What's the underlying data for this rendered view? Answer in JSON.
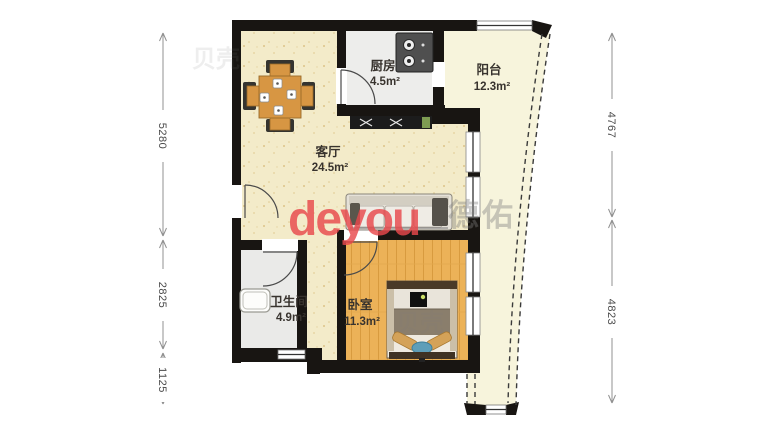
{
  "rooms": [
    {
      "name": "客厅",
      "area": "24.5m²"
    },
    {
      "name": "厨房",
      "area": "4.5m²"
    },
    {
      "name": "阳台",
      "area": "12.3m²"
    },
    {
      "name": "卫生间",
      "area": "4.9m²"
    },
    {
      "name": "卧室",
      "area": "11.3m²"
    }
  ],
  "dimensions": {
    "left": [
      "5280",
      "2825",
      "1125"
    ],
    "right": [
      "4767",
      "4823"
    ]
  },
  "watermark": {
    "logo": "deyou",
    "brand_cjk": "德佑",
    "faint_mark": "贝壳"
  },
  "colors": {
    "wall": "#181512",
    "living_floor": "#f3ebc9",
    "wood_floor": "#ecb258",
    "balcony_floor": "#f7f4dc",
    "tile_floor": "#ededeb",
    "bath_floor": "#eaeae8",
    "watermark_red": "#e8484c",
    "dimension_line": "#909090"
  },
  "icons": {
    "furniture": [
      "dining-table-icon",
      "stove-icon",
      "tv-cabinet-icon",
      "sofa-icon",
      "bed-icon",
      "bathtub-icon"
    ],
    "openings": [
      "door-arc-icon",
      "window-icon",
      "curtain-wall-dashed-icon"
    ]
  }
}
